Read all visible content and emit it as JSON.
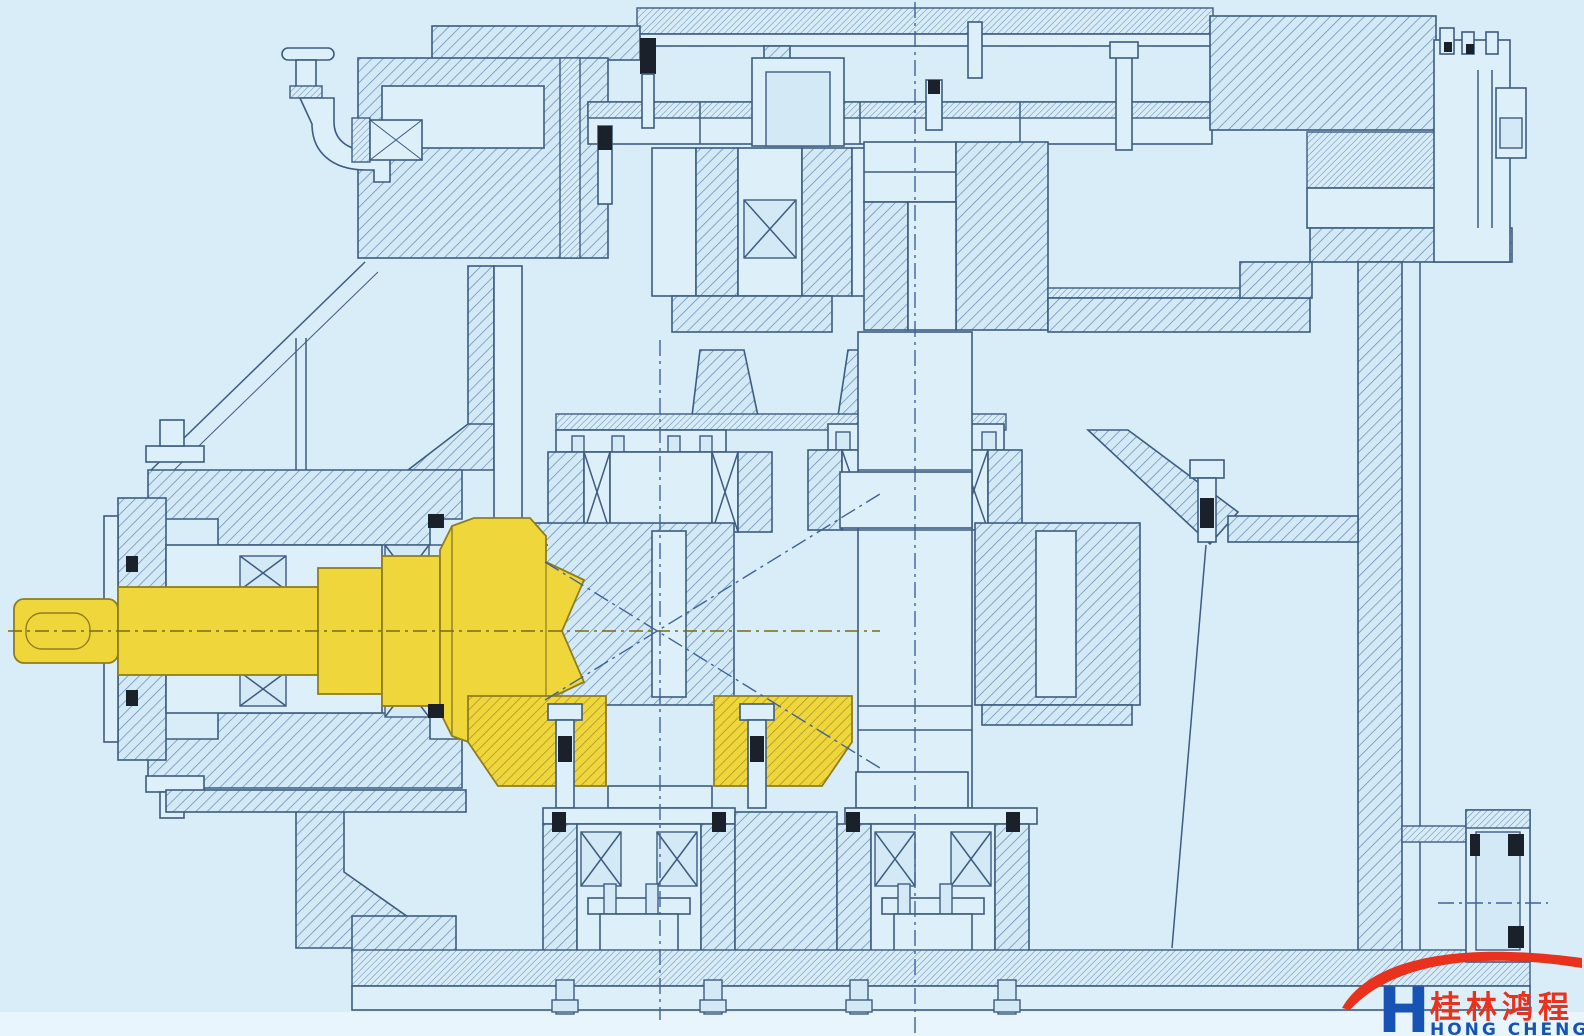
{
  "logo": {
    "chinese": "桂林鸿程",
    "english": "HONG CHENG"
  },
  "palette": {
    "background": "#d9edf8",
    "line": "#3d5c80",
    "hatch_fill": "#d3eaf6",
    "hatch_line": "#6488b3",
    "highlight_yellow": "#efd73b",
    "highlight_edge": "#8f7d1f",
    "seal_black": "#1a212b",
    "logo_red": "#e8321e",
    "logo_blue": "#1653b5"
  },
  "diagram": {
    "kind": "sectional engineering drawing",
    "subject": "gear reducer cross-section",
    "highlighted_parts": [
      "input-bevel-pinion-shaft",
      "bevel-ring-gear"
    ]
  }
}
